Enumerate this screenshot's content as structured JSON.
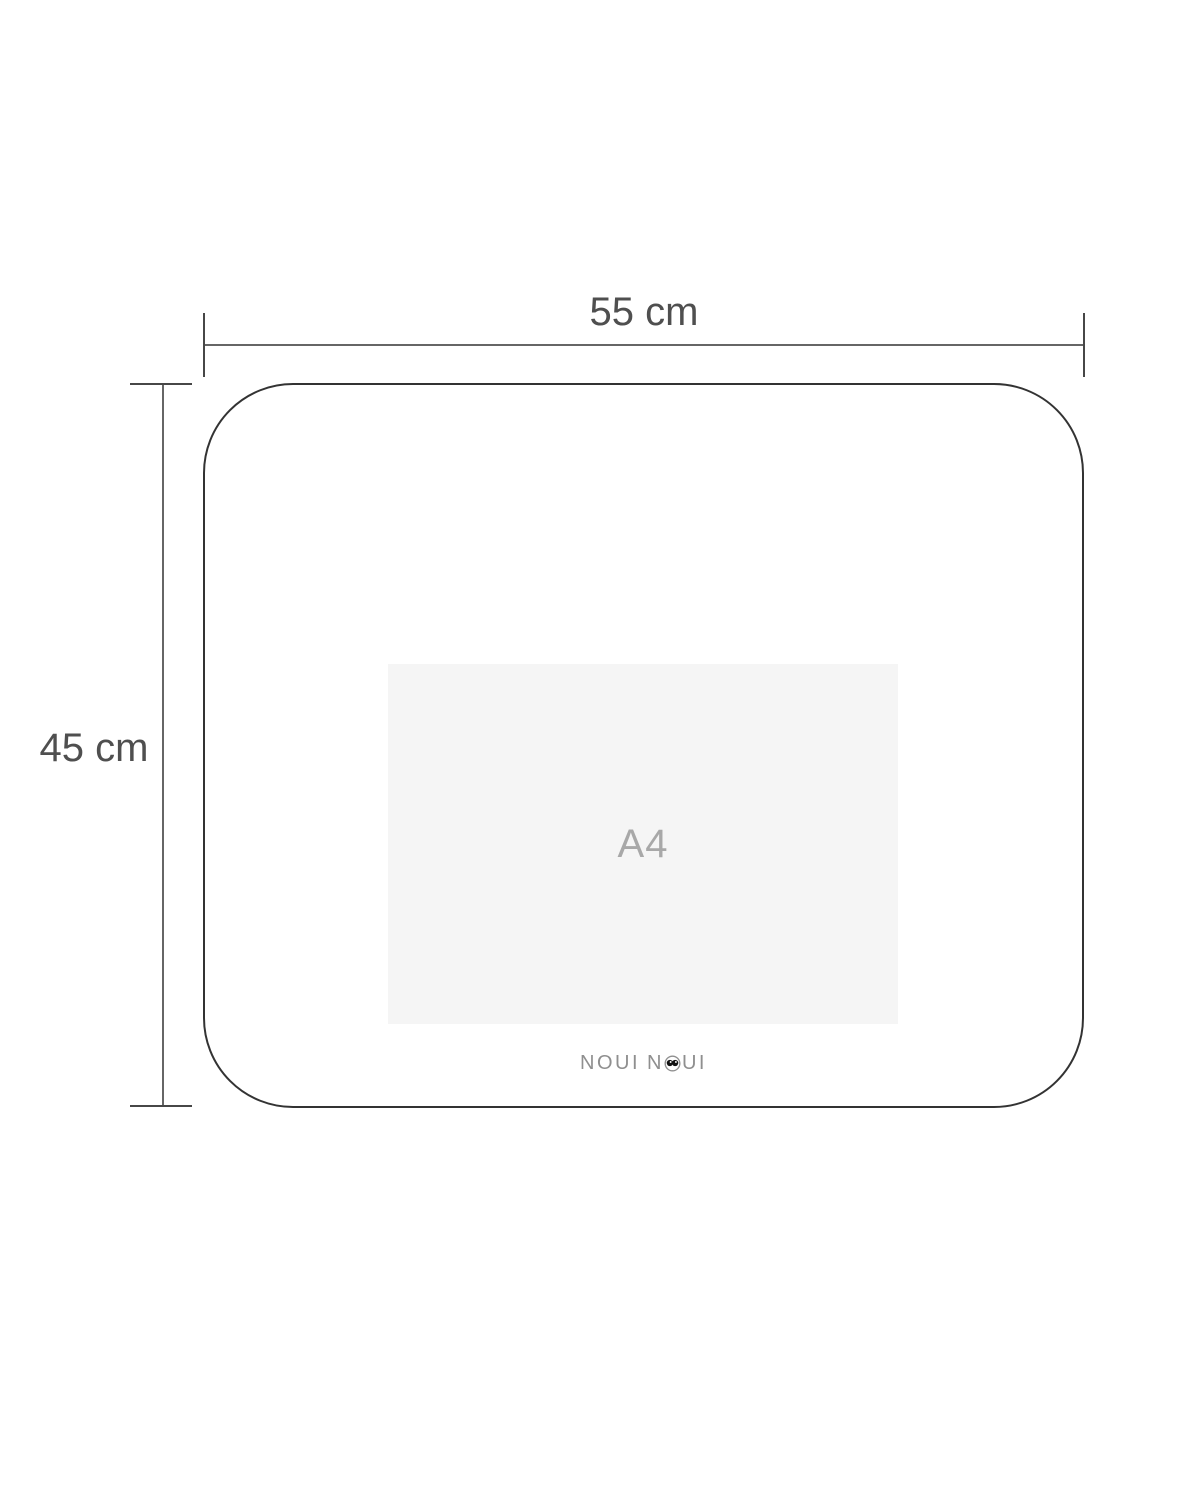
{
  "diagram": {
    "title": "placemat dimension diagram",
    "width_dimension": {
      "label": "55 cm"
    },
    "height_dimension": {
      "label": "45 cm"
    },
    "a4_reference": {
      "label": "A4"
    },
    "brand": {
      "name": "NOUI NOUI",
      "word1": "NOUI",
      "word2_prefix": "N",
      "word2_suffix": "UI"
    },
    "colors": {
      "outline": "#333333",
      "dimension_line": "#666666",
      "dimension_tick": "#474747",
      "dimension_label": "#4f4f4f",
      "a4_fill": "#f5f5f5",
      "a4_label": "#a8a8a8",
      "brand_gray": "#8f8f8f",
      "brand_eyes": "#111111"
    }
  }
}
